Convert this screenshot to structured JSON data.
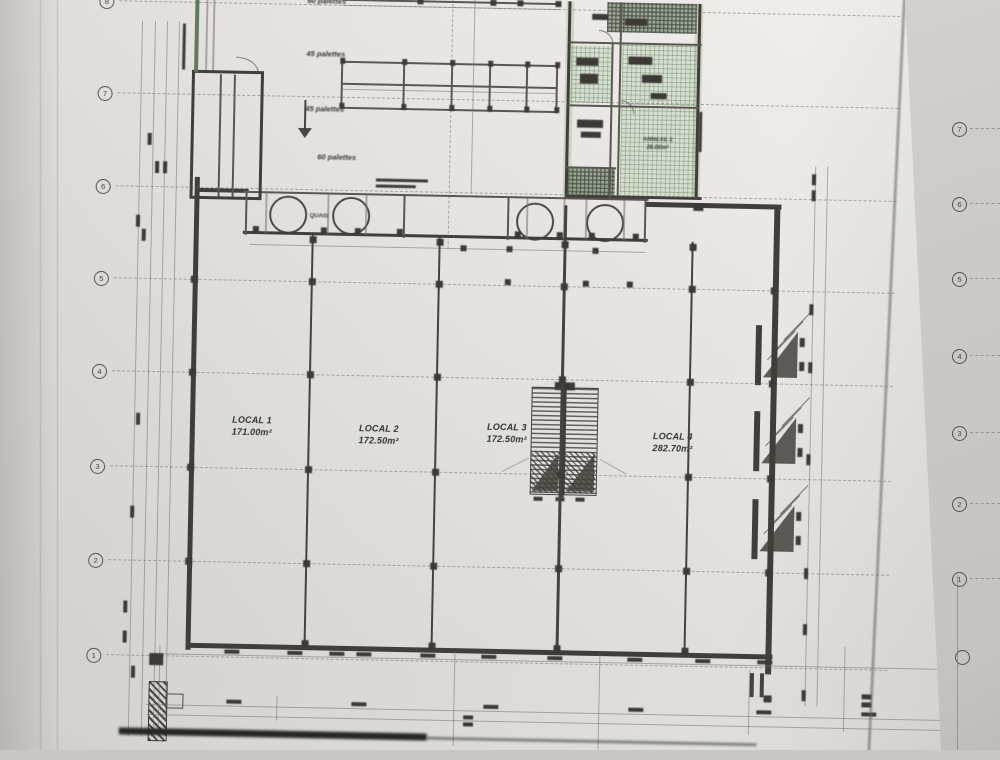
{
  "sheet": {
    "locals": [
      {
        "name": "LOCAL 1",
        "area": "171.00m²"
      },
      {
        "name": "LOCAL 2",
        "area": "172.50m²"
      },
      {
        "name": "LOCAL 3",
        "area": "172.50m²"
      },
      {
        "name": "LOCAL 4",
        "area": "282.70m²"
      }
    ],
    "storage_labels": [
      "60 palettes",
      "45 palettes",
      "45 palettes",
      "60 palettes"
    ],
    "dock_label": "QUAIS",
    "annex_room": {
      "name": "ANNEXE 2",
      "area": "26.00m²"
    },
    "grid_left": [
      "8",
      "7",
      "6",
      "5",
      "4",
      "3",
      "2",
      "1"
    ],
    "grid_right": [
      "7",
      "6",
      "5",
      "4",
      "3",
      "2",
      "1"
    ]
  }
}
